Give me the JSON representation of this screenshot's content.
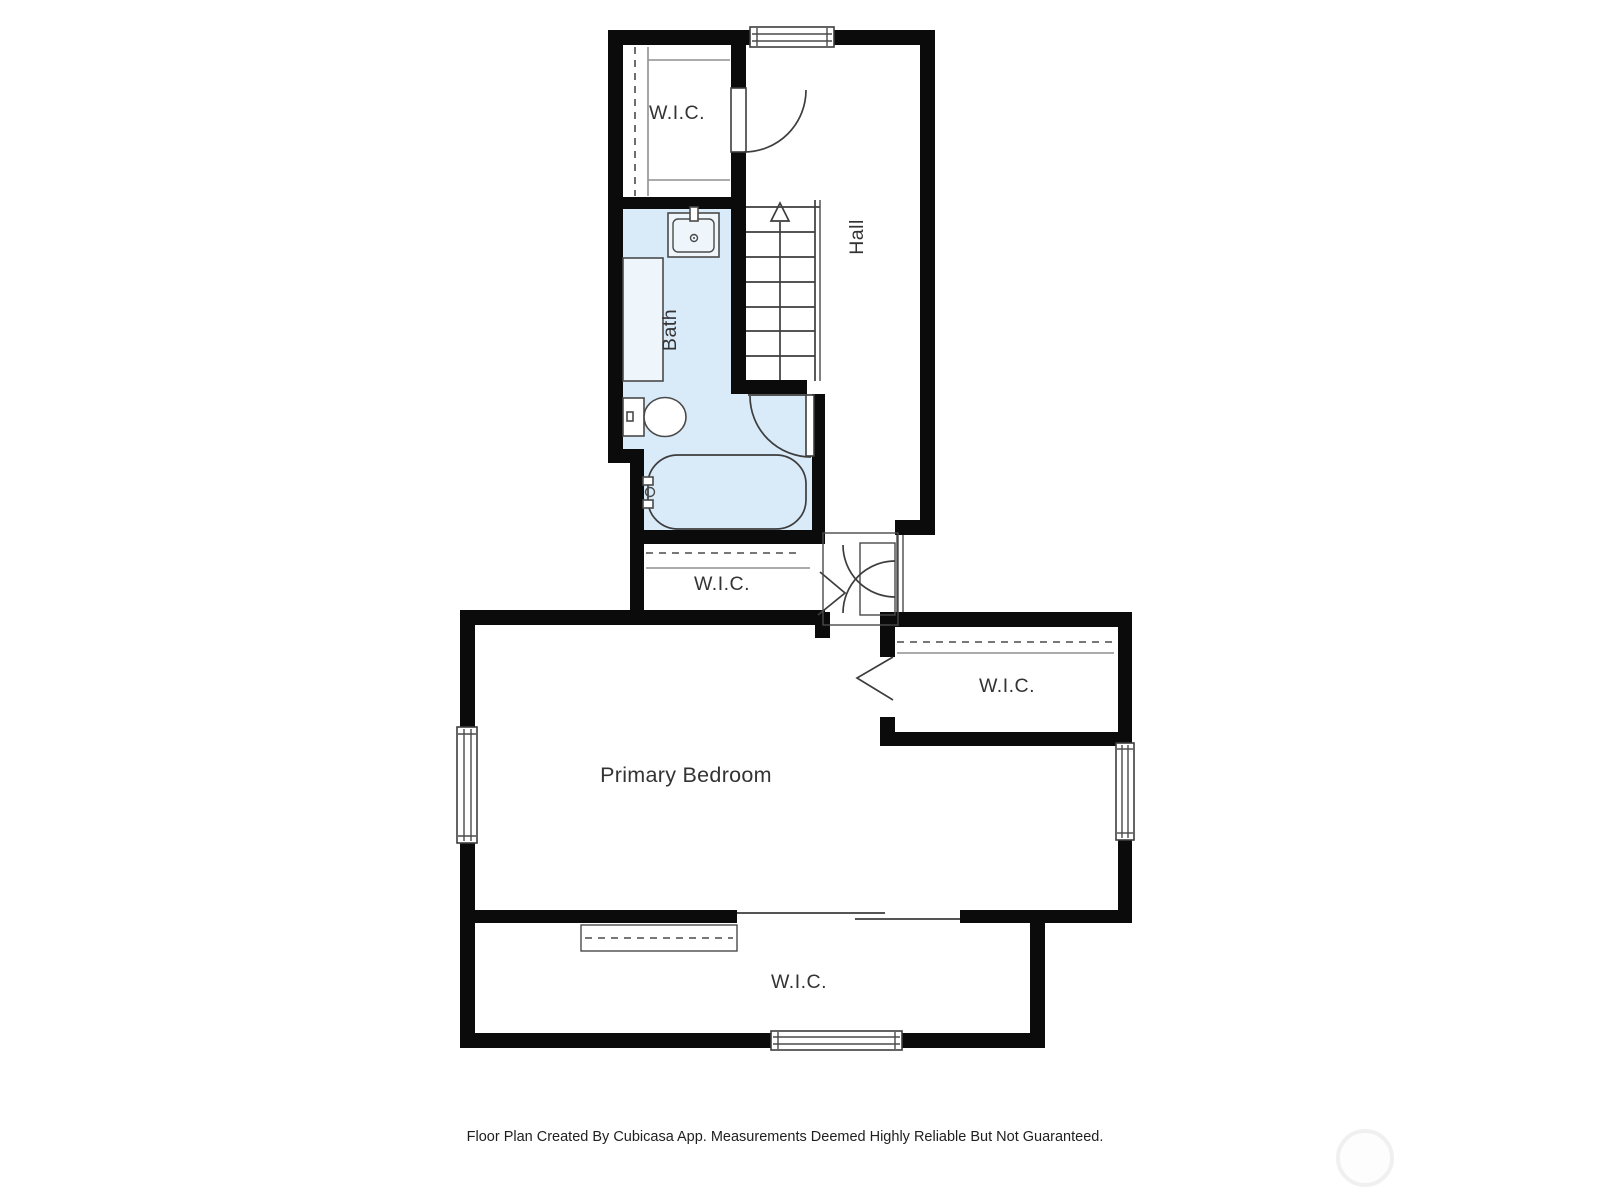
{
  "plan": {
    "rooms": [
      {
        "id": "wic_top",
        "label": "W.I.C."
      },
      {
        "id": "hall",
        "label": "Hall"
      },
      {
        "id": "bath",
        "label": "Bath"
      },
      {
        "id": "wic_mid",
        "label": "W.I.C."
      },
      {
        "id": "wic_right",
        "label": "W.I.C."
      },
      {
        "id": "primary_bedroom",
        "label": "Primary Bedroom"
      },
      {
        "id": "wic_bottom",
        "label": "W.I.C."
      }
    ],
    "footer": "Floor Plan Created By Cubicasa App. Measurements Deemed Highly Reliable But Not Guaranteed.",
    "colors": {
      "wall": "#0b0b0b",
      "bath_fill": "#d9eaf8"
    }
  }
}
